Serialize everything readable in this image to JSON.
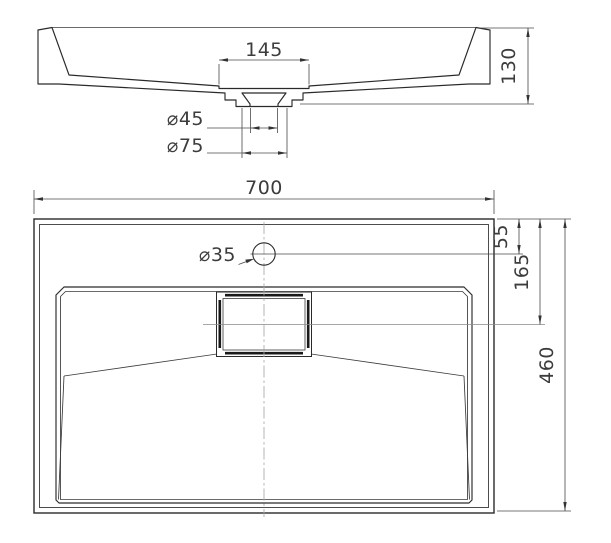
{
  "section_view": {
    "dim_recess_width": "145",
    "dim_drain_inner_diameter": "⌀45",
    "dim_drain_outer_diameter": "⌀75",
    "dim_height": "130"
  },
  "plan_view": {
    "dim_width": "700",
    "dim_faucet_hole_diameter": "⌀35",
    "dim_faucet_offset": "55",
    "dim_drain_center_offset": "165",
    "dim_depth": "460"
  },
  "colors": {
    "background": "#ffffff",
    "outline": "#2a2a2a",
    "dimension": "#4a4a4a",
    "centerline": "#a8a8a8",
    "hatch": "#7a7a7a"
  }
}
